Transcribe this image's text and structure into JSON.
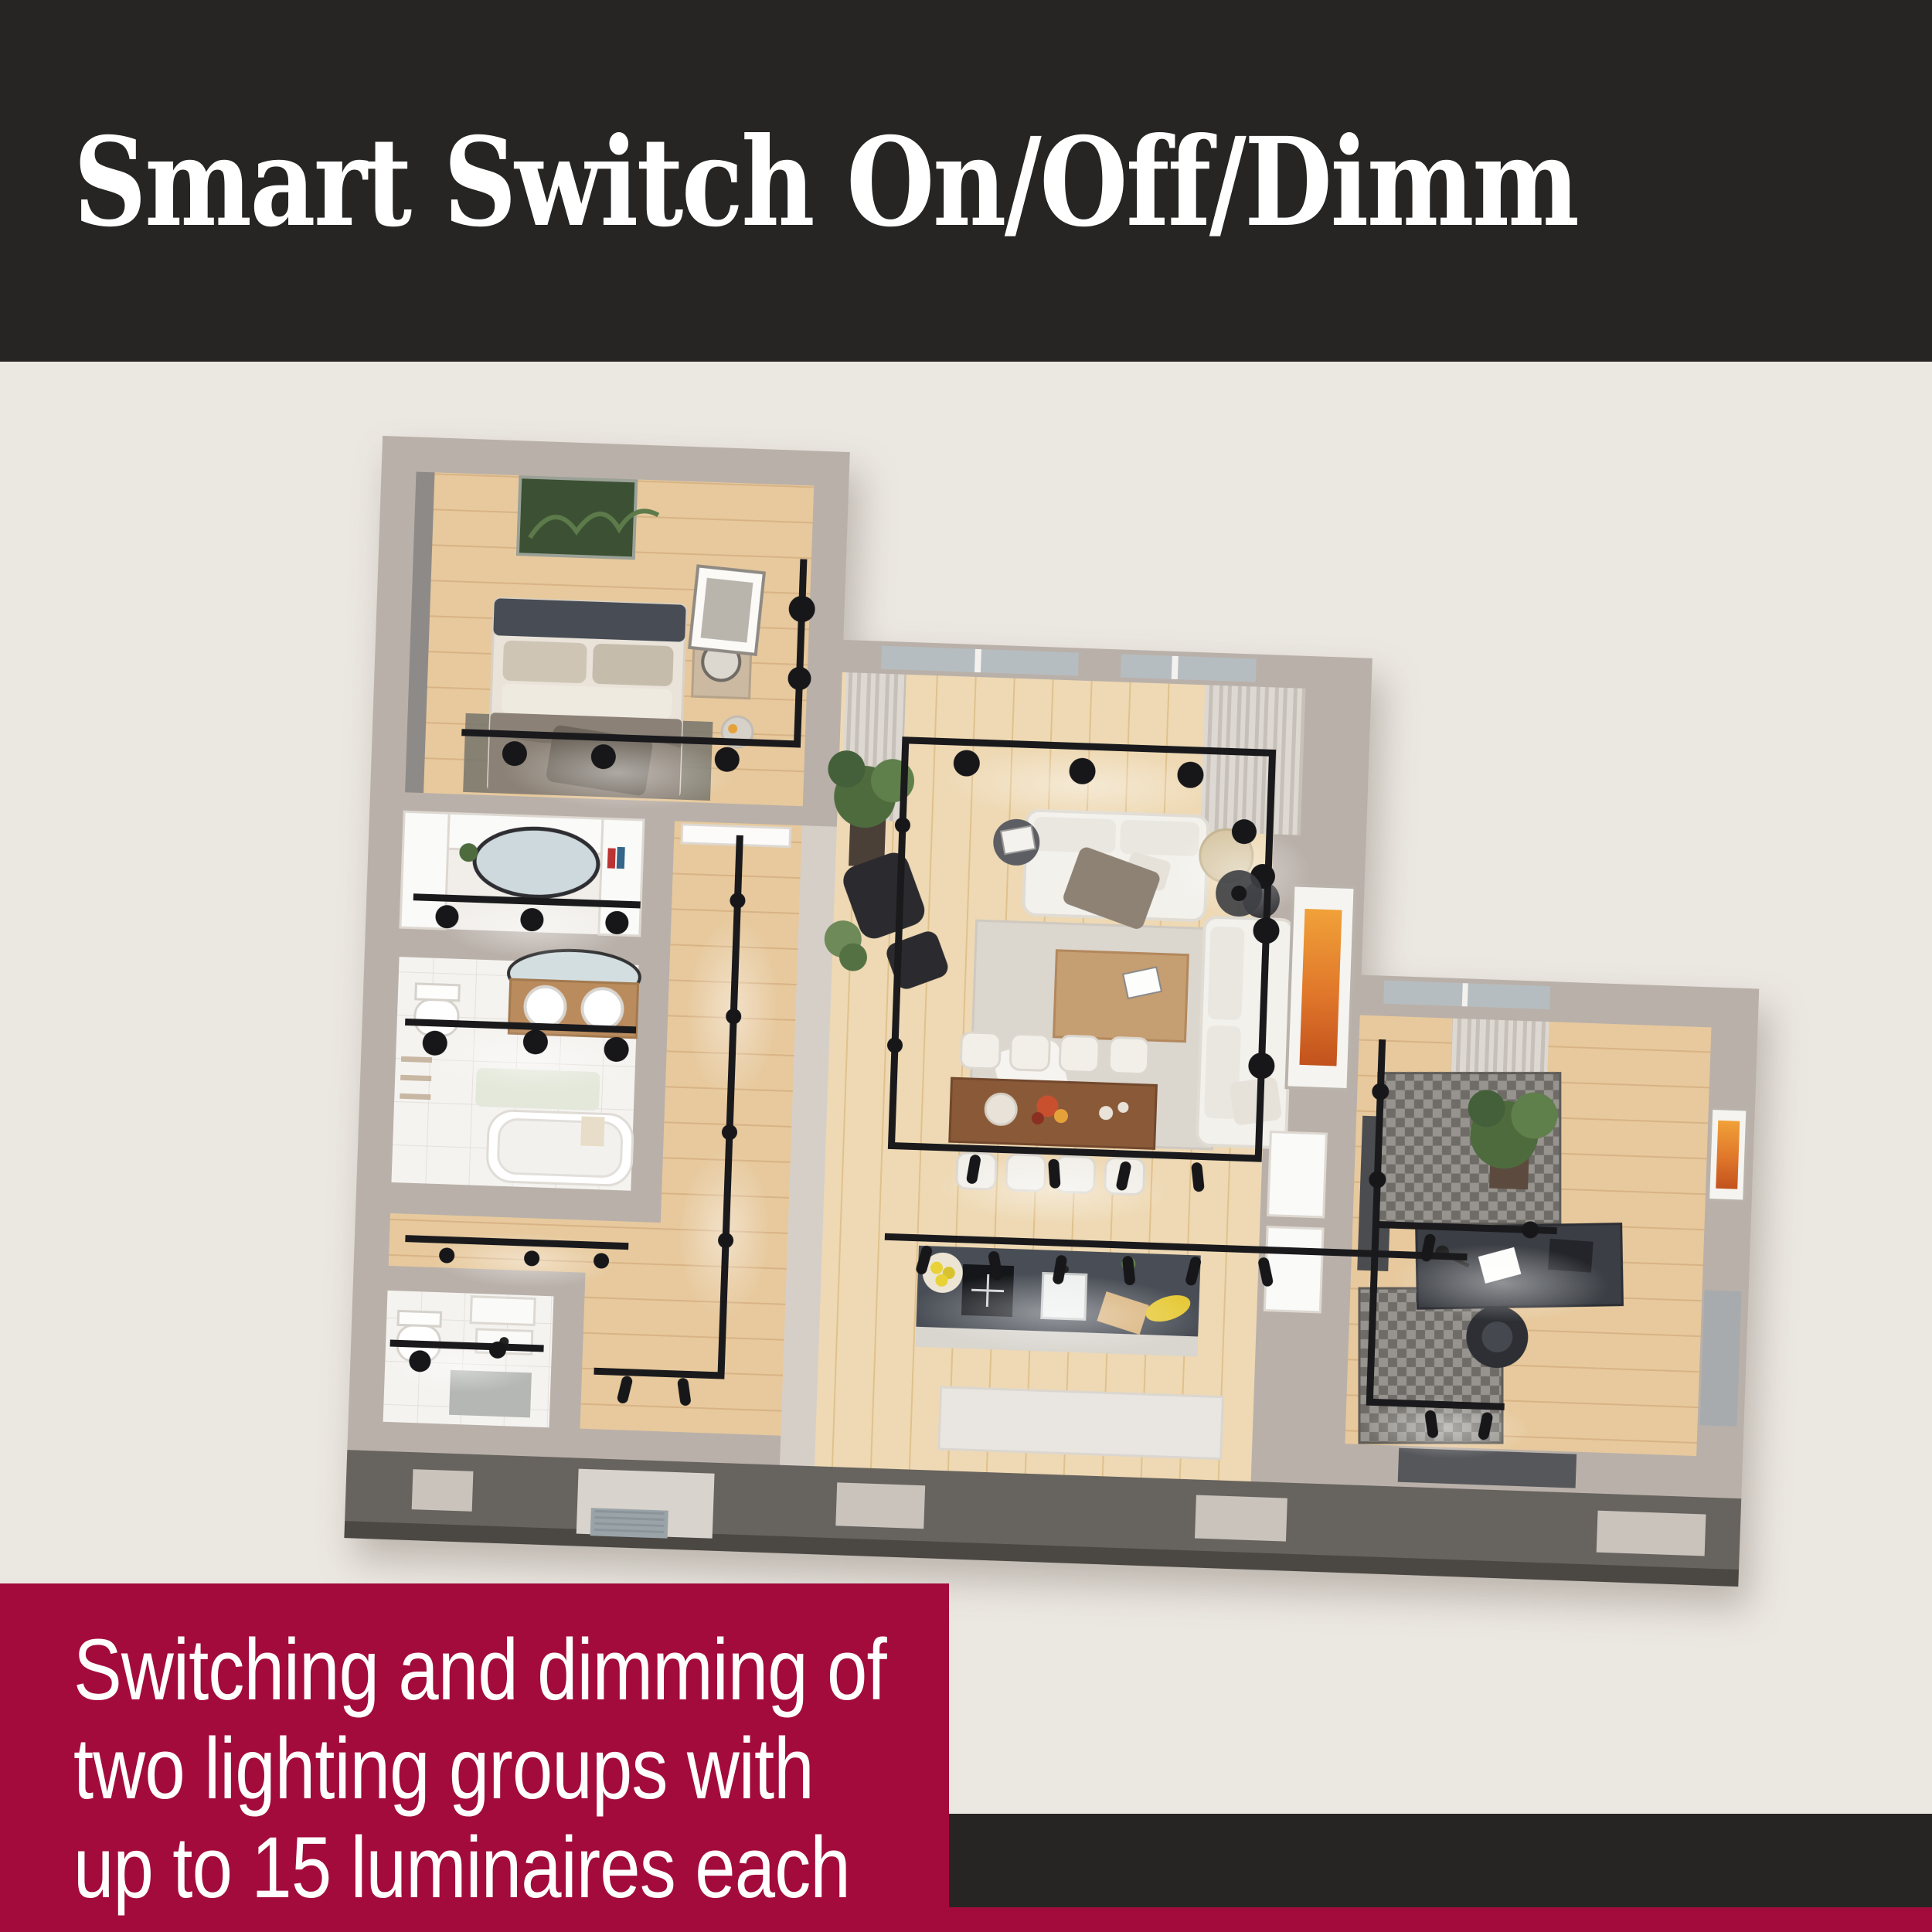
{
  "header": {
    "title": "Smart Switch On/Off/Dimm"
  },
  "caption": {
    "lines": [
      "Switching and dimming of",
      "two lighting groups with",
      "up to 15 luminaires each"
    ]
  },
  "colors": {
    "page-bg": "#ebe7e1",
    "band-dark": "#262523",
    "accent-red": "#a30b3c",
    "text-light": "#ffffff",
    "wall": "#b9b0a9",
    "wood": "#e7c99d",
    "wood-light": "#eed9b4",
    "tile": "#f5f3f0",
    "front-wall": "#67635e",
    "track-black": "#1a1a1d"
  },
  "floorplan": {
    "description": "3D top view of an apartment, every room lit by black track luminaires",
    "rooms": [
      "bedroom",
      "dressing room",
      "bathroom",
      "guest WC",
      "hallway",
      "living room",
      "dining area",
      "kitchen",
      "home office"
    ]
  }
}
